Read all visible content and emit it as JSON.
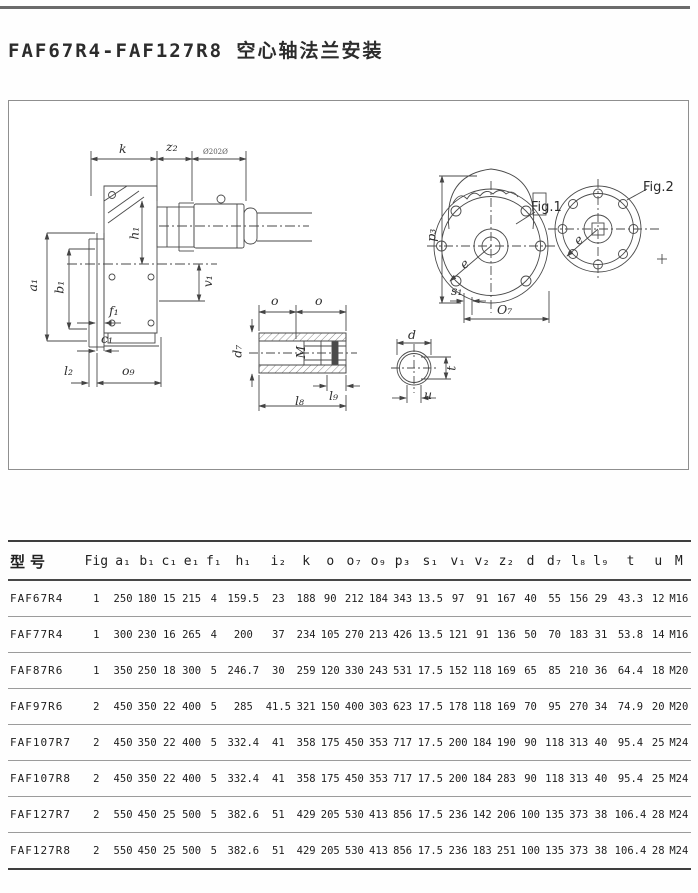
{
  "title": "FAF67R4-FAF127R8 空心轴法兰安装",
  "drawing": {
    "side_view": {
      "k": "k",
      "z2": "z₂",
      "motor_label": "Ø202Ø",
      "a1": "a₁",
      "b1": "b₁",
      "h1": "h₁",
      "v1": "v₁",
      "f1": "f₁",
      "c1": "c₁",
      "l2": "l₂",
      "o9": "o₉"
    },
    "hollow_shaft": {
      "o_left": "o",
      "o_right": "o",
      "d7": "d₇",
      "m": "M",
      "l9": "l₉",
      "l8": "l₈"
    },
    "shaft_section": {
      "d": "d",
      "t": "t",
      "u": "u"
    },
    "fig1": {
      "caption": "Fig.1",
      "p3": "p₃",
      "e": "e",
      "s1": "s₁",
      "o7": "O₇"
    },
    "fig2": {
      "caption": "Fig.2",
      "e": "e"
    }
  },
  "table": {
    "columns": [
      "型号",
      "Fig",
      "a₁",
      "b₁",
      "c₁",
      "e₁",
      "f₁",
      "h₁",
      "i₂",
      "k",
      "o",
      "o₇",
      "o₉",
      "p₃",
      "s₁",
      "v₁",
      "v₂",
      "z₂",
      "d",
      "d₇",
      "l₈",
      "l₉",
      "t",
      "u",
      "M"
    ],
    "rows": [
      [
        "FAF67R4",
        "1",
        "250",
        "180",
        "15",
        "215",
        "4",
        "159.5",
        "23",
        "188",
        "90",
        "212",
        "184",
        "343",
        "13.5",
        "97",
        "91",
        "167",
        "40",
        "55",
        "156",
        "29",
        "43.3",
        "12",
        "M16"
      ],
      [
        "FAF77R4",
        "1",
        "300",
        "230",
        "16",
        "265",
        "4",
        "200",
        "37",
        "234",
        "105",
        "270",
        "213",
        "426",
        "13.5",
        "121",
        "91",
        "136",
        "50",
        "70",
        "183",
        "31",
        "53.8",
        "14",
        "M16"
      ],
      [
        "FAF87R6",
        "1",
        "350",
        "250",
        "18",
        "300",
        "5",
        "246.7",
        "30",
        "259",
        "120",
        "330",
        "243",
        "531",
        "17.5",
        "152",
        "118",
        "169",
        "65",
        "85",
        "210",
        "36",
        "64.4",
        "18",
        "M20"
      ],
      [
        "FAF97R6",
        "2",
        "450",
        "350",
        "22",
        "400",
        "5",
        "285",
        "41.5",
        "321",
        "150",
        "400",
        "303",
        "623",
        "17.5",
        "178",
        "118",
        "169",
        "70",
        "95",
        "270",
        "34",
        "74.9",
        "20",
        "M20"
      ],
      [
        "FAF107R7",
        "2",
        "450",
        "350",
        "22",
        "400",
        "5",
        "332.4",
        "41",
        "358",
        "175",
        "450",
        "353",
        "717",
        "17.5",
        "200",
        "184",
        "190",
        "90",
        "118",
        "313",
        "40",
        "95.4",
        "25",
        "M24"
      ],
      [
        "FAF107R8",
        "2",
        "450",
        "350",
        "22",
        "400",
        "5",
        "332.4",
        "41",
        "358",
        "175",
        "450",
        "353",
        "717",
        "17.5",
        "200",
        "184",
        "283",
        "90",
        "118",
        "313",
        "40",
        "95.4",
        "25",
        "M24"
      ],
      [
        "FAF127R7",
        "2",
        "550",
        "450",
        "25",
        "500",
        "5",
        "382.6",
        "51",
        "429",
        "205",
        "530",
        "413",
        "856",
        "17.5",
        "236",
        "142",
        "206",
        "100",
        "135",
        "373",
        "38",
        "106.4",
        "28",
        "M24"
      ],
      [
        "FAF127R8",
        "2",
        "550",
        "450",
        "25",
        "500",
        "5",
        "382.6",
        "51",
        "429",
        "205",
        "530",
        "413",
        "856",
        "17.5",
        "236",
        "183",
        "251",
        "100",
        "135",
        "373",
        "38",
        "106.4",
        "28",
        "M24"
      ]
    ]
  }
}
